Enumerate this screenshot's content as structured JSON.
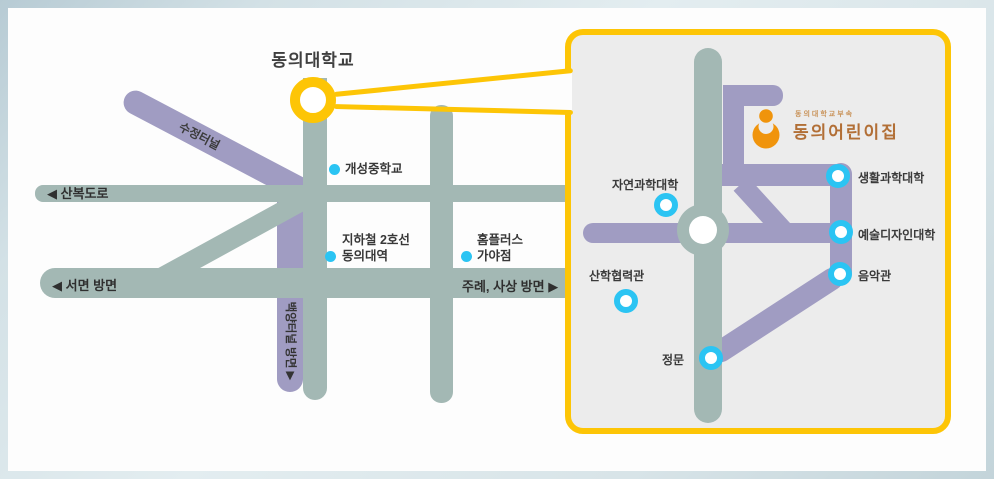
{
  "map": {
    "title": "동의대학교",
    "road_labels": {
      "sujeong_tunnel": "수정터널",
      "sanbok_road": "◀ 산복도로",
      "seomyeon": "◀ 서면 방면",
      "jurye_sasang": "주례, 사상 방면 ▶",
      "baekyang_tunnel": "백양터널 방면  ▶"
    },
    "landmarks": {
      "gaeseong_middle_school": "개성중학교",
      "subway_line": "지하철 2호선",
      "subway_station": "동의대역",
      "homeplus": "홈플러스",
      "homeplus_branch": "가야점"
    }
  },
  "inset": {
    "logo": {
      "affiliation": "동의대학교부속",
      "name": "동의어린이집"
    },
    "locations": {
      "natural_science_college": "자연과학대학",
      "life_science_college": "생활과학대학",
      "art_design_college": "예술디자인대학",
      "music_hall": "음악관",
      "industry_academic_hall": "산학협력관",
      "main_gate": "정문"
    }
  },
  "colors": {
    "road_sage": "#a3b8b4",
    "road_purple": "#a09cc2",
    "highlight_yellow": "#fdc506",
    "marker_cyan": "#2bc4f3",
    "logo_orange": "#f0940c",
    "logo_text_brown": "#b26f36",
    "inset_background": "#ececec",
    "frame_blue": "#c3d4da",
    "label_text": "#3a3a3a"
  }
}
